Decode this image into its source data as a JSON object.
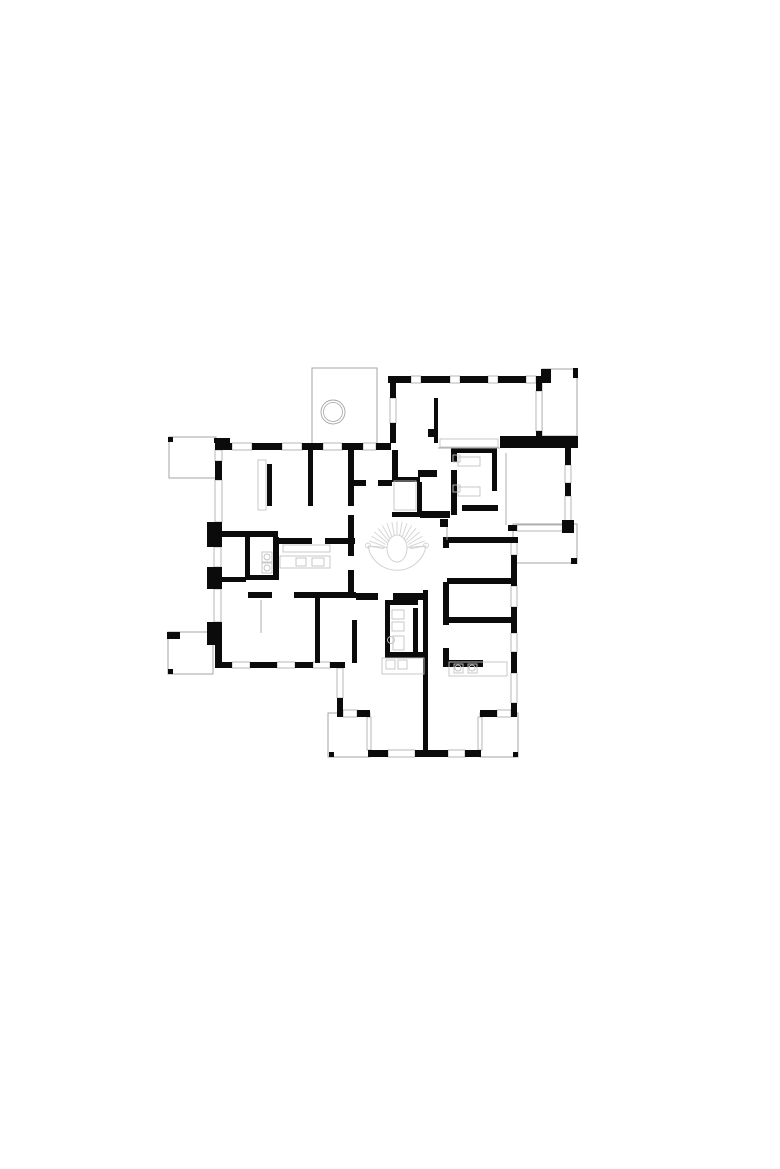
{
  "page": {
    "kind": "architectural-floor-plan",
    "background": "#ffffff"
  },
  "plan": {
    "canvas": {
      "width": 780,
      "height": 1169
    },
    "colors": {
      "wall": "#0b0b0b",
      "thin": "#a6a6a6",
      "furniture": "#c2c2c2",
      "stair": "#d2d2d2",
      "paper": "#ffffff"
    },
    "layers": {
      "outlines": [
        [
          312,
          368,
          65,
          76
        ],
        [
          542,
          369,
          35,
          67
        ],
        [
          513,
          524,
          64,
          39
        ],
        [
          169,
          437,
          47,
          41
        ],
        [
          168,
          632,
          45,
          42
        ],
        [
          328,
          713,
          42,
          44
        ],
        [
          480,
          713,
          38,
          44
        ]
      ],
      "windows": [
        [
          411,
          376,
          10,
          7
        ],
        [
          450,
          376,
          10,
          7
        ],
        [
          488,
          376,
          10,
          7
        ],
        [
          526,
          376,
          10,
          7
        ],
        [
          390,
          398,
          6,
          25
        ],
        [
          536,
          391,
          6,
          40
        ],
        [
          232,
          443,
          20,
          7
        ],
        [
          282,
          443,
          20,
          7
        ],
        [
          323,
          443,
          19,
          7
        ],
        [
          363,
          443,
          13,
          7
        ],
        [
          215,
          450,
          7,
          11
        ],
        [
          215,
          480,
          7,
          42
        ],
        [
          214,
          547,
          7,
          20
        ],
        [
          214,
          589,
          7,
          33
        ],
        [
          232,
          662,
          18,
          6
        ],
        [
          277,
          662,
          18,
          6
        ],
        [
          313,
          662,
          17,
          6
        ],
        [
          337,
          668,
          6,
          30
        ],
        [
          343,
          710,
          14,
          7
        ],
        [
          367,
          717,
          4,
          33
        ],
        [
          388,
          750,
          27,
          7
        ],
        [
          448,
          750,
          17,
          7
        ],
        [
          478,
          717,
          4,
          33
        ],
        [
          497,
          710,
          14,
          7
        ],
        [
          511,
          538,
          6,
          17
        ],
        [
          511,
          586,
          6,
          21
        ],
        [
          511,
          633,
          6,
          19
        ],
        [
          511,
          673,
          6,
          30
        ],
        [
          565,
          465,
          6,
          18
        ],
        [
          565,
          496,
          6,
          25
        ],
        [
          517,
          525,
          46,
          6
        ]
      ],
      "walls": [
        [
          388,
          376,
          23,
          7
        ],
        [
          421,
          376,
          29,
          7
        ],
        [
          460,
          376,
          28,
          7
        ],
        [
          498,
          376,
          28,
          7
        ],
        [
          536,
          376,
          15,
          7
        ],
        [
          541,
          369,
          10,
          8
        ],
        [
          573,
          368,
          5,
          10
        ],
        [
          390,
          383,
          6,
          15
        ],
        [
          390,
          423,
          6,
          20
        ],
        [
          392,
          450,
          6,
          29
        ],
        [
          434,
          398,
          4,
          45
        ],
        [
          536,
          383,
          6,
          8
        ],
        [
          536,
          431,
          6,
          5
        ],
        [
          500,
          436,
          78,
          12
        ],
        [
          215,
          443,
          17,
          7
        ],
        [
          252,
          443,
          30,
          7
        ],
        [
          302,
          443,
          21,
          7
        ],
        [
          342,
          443,
          21,
          7
        ],
        [
          376,
          443,
          15,
          7
        ],
        [
          215,
          461,
          7,
          19
        ],
        [
          207,
          522,
          15,
          25
        ],
        [
          207,
          567,
          15,
          22
        ],
        [
          207,
          622,
          15,
          23
        ],
        [
          215,
          645,
          7,
          23
        ],
        [
          214,
          438,
          16,
          5
        ],
        [
          168,
          437,
          5,
          5
        ],
        [
          167,
          632,
          13,
          7
        ],
        [
          168,
          669,
          5,
          5
        ],
        [
          267,
          464,
          5,
          42
        ],
        [
          308,
          450,
          5,
          56
        ],
        [
          348,
          450,
          6,
          56
        ],
        [
          222,
          531,
          56,
          6
        ],
        [
          245,
          537,
          5,
          41
        ],
        [
          273,
          537,
          6,
          41
        ],
        [
          245,
          575,
          34,
          5
        ],
        [
          278,
          538,
          34,
          6
        ],
        [
          325,
          538,
          30,
          6
        ],
        [
          348,
          515,
          6,
          41
        ],
        [
          348,
          570,
          6,
          24
        ],
        [
          222,
          577,
          24,
          5
        ],
        [
          248,
          592,
          24,
          6
        ],
        [
          294,
          592,
          62,
          6
        ],
        [
          356,
          593,
          22,
          7
        ],
        [
          393,
          593,
          34,
          7
        ],
        [
          315,
          598,
          5,
          65
        ],
        [
          352,
          620,
          5,
          43
        ],
        [
          216,
          662,
          16,
          6
        ],
        [
          250,
          662,
          27,
          6
        ],
        [
          295,
          662,
          18,
          6
        ],
        [
          330,
          662,
          15,
          6
        ],
        [
          337,
          698,
          6,
          19
        ],
        [
          357,
          710,
          13,
          7
        ],
        [
          368,
          750,
          20,
          7
        ],
        [
          415,
          750,
          33,
          7
        ],
        [
          465,
          750,
          16,
          7
        ],
        [
          329,
          752,
          5,
          5
        ],
        [
          513,
          752,
          5,
          5
        ],
        [
          480,
          710,
          17,
          7
        ],
        [
          511,
          703,
          6,
          14
        ],
        [
          511,
          555,
          6,
          31
        ],
        [
          511,
          607,
          6,
          26
        ],
        [
          511,
          652,
          6,
          21
        ],
        [
          565,
          448,
          6,
          17
        ],
        [
          565,
          483,
          6,
          13
        ],
        [
          565,
          521,
          6,
          10
        ],
        [
          508,
          525,
          9,
          6
        ],
        [
          563,
          525,
          10,
          6
        ],
        [
          562,
          520,
          12,
          13
        ],
        [
          571,
          558,
          6,
          6
        ],
        [
          448,
          537,
          70,
          6
        ],
        [
          447,
          578,
          66,
          6
        ],
        [
          447,
          617,
          66,
          6
        ],
        [
          447,
          660,
          36,
          7
        ],
        [
          443,
          537,
          6,
          11
        ],
        [
          443,
          582,
          6,
          43
        ],
        [
          443,
          648,
          6,
          19
        ],
        [
          418,
          470,
          19,
          7
        ],
        [
          428,
          429,
          9,
          8
        ],
        [
          451,
          448,
          6,
          14
        ],
        [
          451,
          470,
          6,
          45
        ],
        [
          457,
          448,
          40,
          5
        ],
        [
          492,
          453,
          5,
          38
        ],
        [
          462,
          505,
          36,
          6
        ],
        [
          420,
          511,
          30,
          7
        ],
        [
          440,
          519,
          8,
          8
        ],
        [
          392,
          477,
          28,
          5
        ],
        [
          392,
          512,
          28,
          5
        ],
        [
          417,
          482,
          5,
          30
        ],
        [
          352,
          480,
          14,
          6
        ],
        [
          378,
          480,
          14,
          6
        ],
        [
          423,
          590,
          5,
          165
        ],
        [
          385,
          600,
          33,
          5
        ],
        [
          385,
          600,
          5,
          53
        ],
        [
          413,
          608,
          5,
          45
        ],
        [
          385,
          652,
          42,
          6
        ]
      ],
      "furniture_rects": [
        [
          258,
          460,
          8,
          50
        ],
        [
          262,
          552,
          10,
          10
        ],
        [
          262,
          563,
          10,
          10
        ],
        [
          283,
          545,
          47,
          7
        ],
        [
          280,
          556,
          50,
          12
        ],
        [
          296,
          558,
          10,
          8
        ],
        [
          312,
          558,
          12,
          8
        ],
        [
          440,
          439,
          58,
          8
        ],
        [
          458,
          457,
          22,
          9
        ],
        [
          453,
          455,
          7,
          7
        ],
        [
          458,
          487,
          22,
          9
        ],
        [
          453,
          485,
          7,
          7
        ],
        [
          394,
          481,
          22,
          29
        ],
        [
          392,
          610,
          12,
          9
        ],
        [
          392,
          622,
          12,
          9
        ],
        [
          393,
          636,
          11,
          14
        ],
        [
          382,
          658,
          42,
          16
        ],
        [
          386,
          660,
          9,
          9
        ],
        [
          398,
          660,
          9,
          9
        ],
        [
          449,
          662,
          58,
          14
        ],
        [
          454,
          664,
          9,
          9
        ],
        [
          468,
          664,
          9,
          9
        ]
      ],
      "furniture_circles": [
        [
          267,
          557,
          3
        ],
        [
          267,
          568,
          3
        ],
        [
          391,
          640,
          3.5
        ],
        [
          458,
          668,
          3
        ],
        [
          472,
          668,
          3
        ]
      ],
      "glazing_lines": [
        [
          506,
          453,
          506,
          525
        ],
        [
          438,
          448,
          500,
          448
        ],
        [
          447,
          527,
          447,
          540
        ],
        [
          261,
          600,
          261,
          633
        ]
      ]
    },
    "terrace": {
      "circle": {
        "cx": 333,
        "cy": 412,
        "r_outer": 12,
        "r_inner": 9.5
      }
    },
    "stair": {
      "cx": 397,
      "cy": 551,
      "outer_r": 29.5,
      "inner_r": 13,
      "start_deg": 190,
      "end_deg": 350,
      "step_deg": 10,
      "oval": {
        "cx": 397,
        "cy": 548.5,
        "rx": 10,
        "ry": 13.5
      },
      "curls": [
        [
          368,
          545.5
        ],
        [
          426,
          545.5
        ]
      ],
      "chords": [
        [
          368,
          546,
          387,
          547.5
        ],
        [
          407,
          547.5,
          426,
          546
        ]
      ]
    }
  }
}
